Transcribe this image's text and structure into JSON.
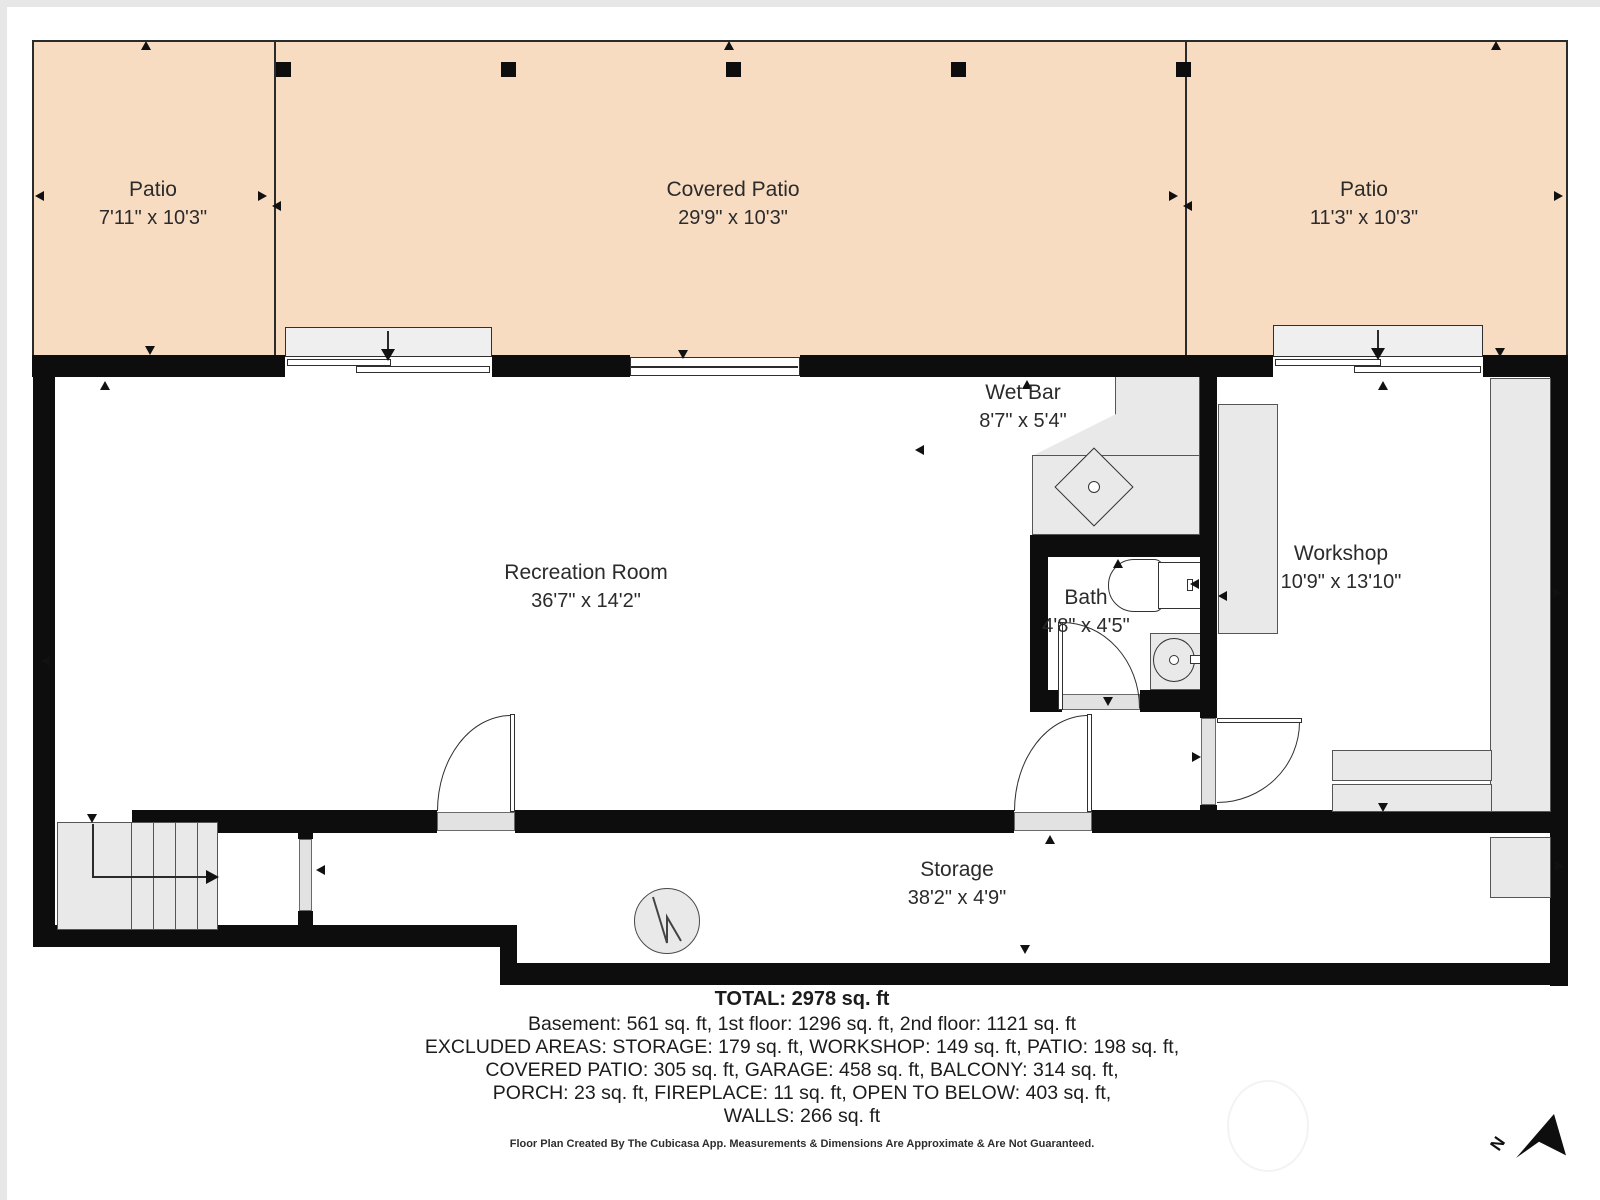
{
  "rooms": [
    {
      "name": "Patio",
      "dims": "7'11\" x 10'3\""
    },
    {
      "name": "Covered Patio",
      "dims": "29'9\" x 10'3\""
    },
    {
      "name": "Patio",
      "dims": "11'3\" x 10'3\""
    },
    {
      "name": "Recreation Room",
      "dims": "36'7\" x 14'2\""
    },
    {
      "name": "Wet Bar",
      "dims": "8'7\" x 5'4\""
    },
    {
      "name": "Bath",
      "dims": "4'8\" x 4'5\""
    },
    {
      "name": "Workshop",
      "dims": "10'9\" x 13'10\""
    },
    {
      "name": "Storage",
      "dims": "38'2\" x 4'9\""
    }
  ],
  "summary": {
    "total": "TOTAL: 2978 sq. ft",
    "line1": "Basement: 561 sq. ft, 1st floor: 1296 sq. ft, 2nd floor: 1121 sq. ft",
    "line2": "EXCLUDED AREAS: STORAGE: 179 sq. ft, WORKSHOP: 149 sq. ft, PATIO: 198 sq. ft,",
    "line3": "COVERED PATIO: 305 sq. ft, GARAGE: 458 sq. ft, BALCONY: 314 sq. ft,",
    "line4": "PORCH: 23 sq. ft, FIREPLACE: 11 sq. ft, OPEN TO BELOW: 403 sq. ft,",
    "line5": "WALLS: 266 sq. ft"
  },
  "footer": {
    "disclaimer": "Floor Plan Created By The Cubicasa App. Measurements & Dimensions Are Approximate & Are Not Guaranteed."
  },
  "compass": {
    "north_label": "N"
  },
  "colors": {
    "patio_fill": "#f8dcc2",
    "wall": "#0d0d0d",
    "fixture_gray": "#e9e9e9"
  }
}
